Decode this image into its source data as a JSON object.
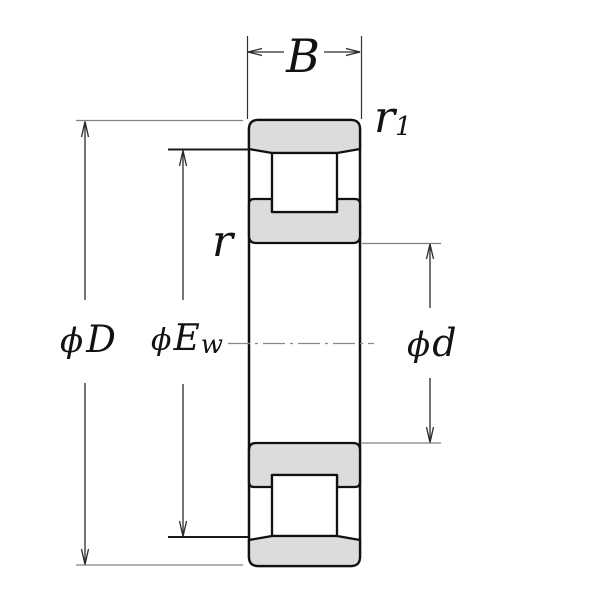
{
  "diagram": {
    "kind": "cylindrical-roller-bearing-cross-section",
    "dimensions": {
      "width": {
        "label": "B"
      },
      "outer_diameter": {
        "phi": "ϕ",
        "label": "D"
      },
      "raceway_diameter": {
        "phi": "ϕ",
        "label": "E",
        "sub": "w"
      },
      "bore_diameter": {
        "phi": "ϕ",
        "label": "d"
      },
      "chamfer_outer": {
        "label": "r",
        "sub": "1"
      },
      "chamfer_inner": {
        "label": "r"
      }
    },
    "colors": {
      "ring_fill": "#dcdcdc",
      "outline": "#111111",
      "dimension_line": "#2a2a2a",
      "extension_line_gray": "#808080",
      "extension_line_dark": "#1a1a1a",
      "centerline": "#8a8a8a",
      "background": "#ffffff"
    }
  }
}
